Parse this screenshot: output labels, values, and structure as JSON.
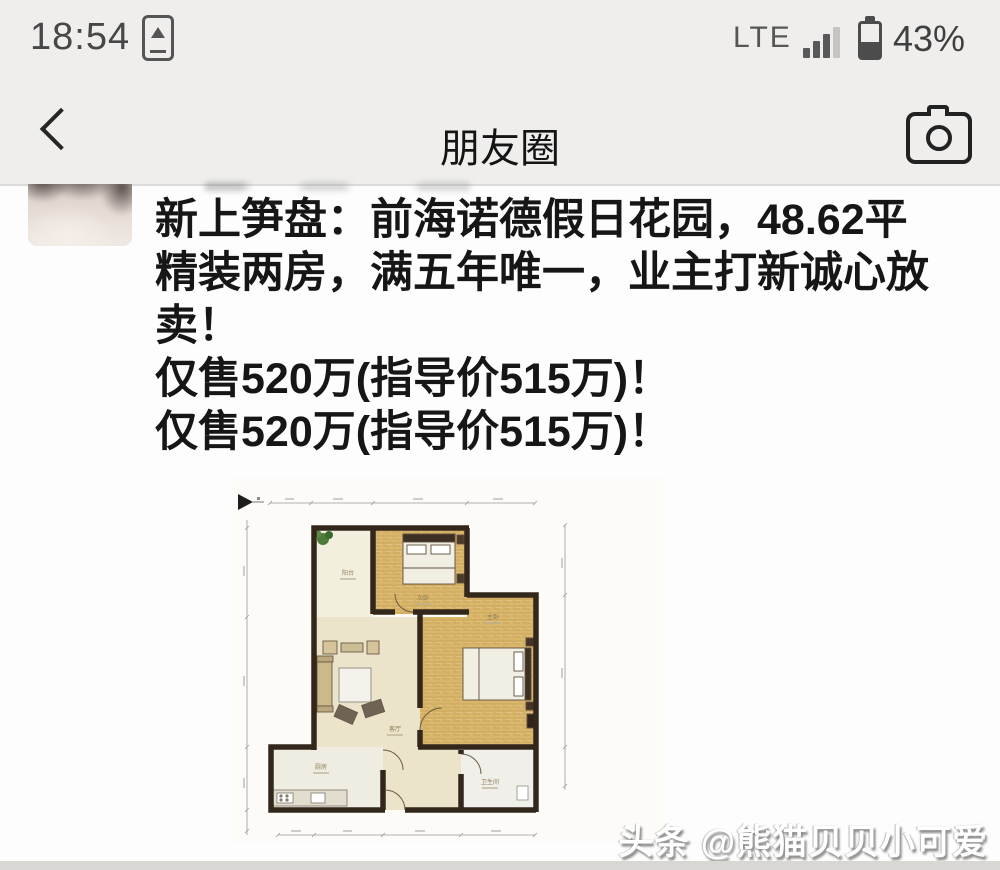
{
  "status_bar": {
    "time": "18:54",
    "network": "LTE",
    "battery_percent": "43%"
  },
  "nav": {
    "title": "朋友圈"
  },
  "post": {
    "text_lines": [
      "新上笋盘：前海诺德假日花园，48.62平",
      "精装两房，满五年唯一，业主打新诚心放",
      "卖！",
      "仅售520万(指导价515万)！",
      "仅售520万(指导价515万)！"
    ]
  },
  "floorplan": {
    "rooms": {
      "balcony": "阳台",
      "bedroom2": "次卧",
      "master": "主卧",
      "living": "客厅",
      "kitchen": "厨房",
      "bathroom": "卫生间"
    }
  },
  "watermark": {
    "text": "头条 @熊猫贝贝小可爱"
  },
  "colors": {
    "header_bg": "#efeeec",
    "post_bg": "#fdfdfd",
    "text": "#161616",
    "wall": "#33271c",
    "wood_floor": "#d9b66c",
    "cream_floor": "#ebe4cb"
  }
}
